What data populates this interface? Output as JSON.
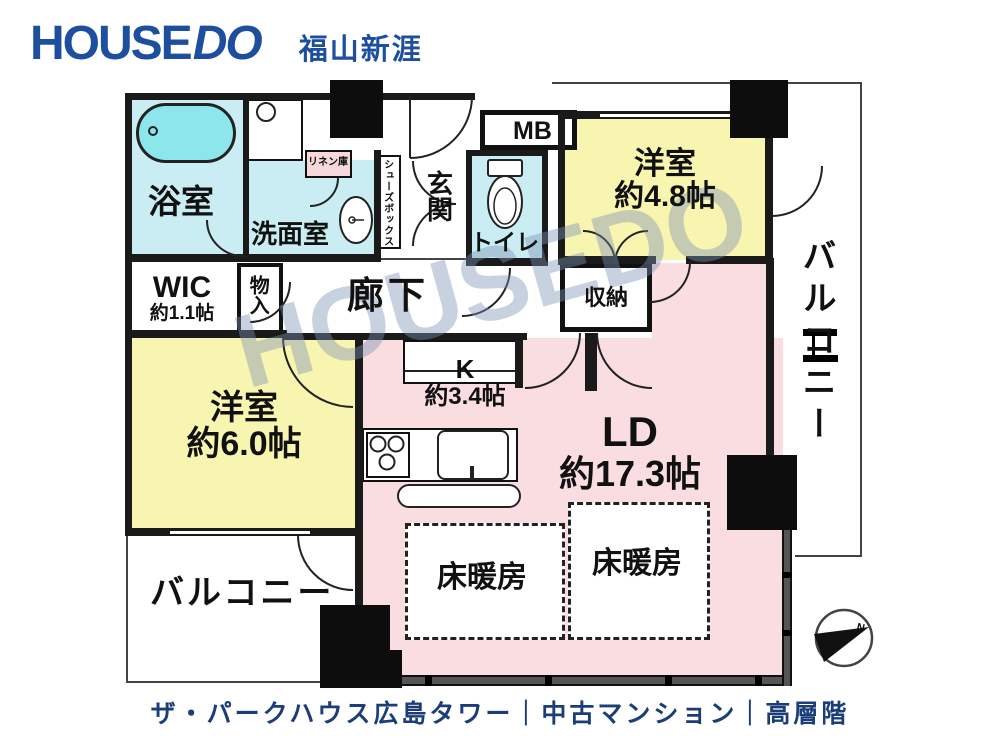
{
  "header": {
    "brand_house": "HOUSE",
    "brand_do": "DO",
    "branch": "福山新涯"
  },
  "watermark": "HOUSEDO",
  "caption": "ザ・パークハウス広島タワー｜中古マンション｜高層階",
  "rooms": {
    "bath": {
      "label": "浴室"
    },
    "powder": {
      "label": "洗面室"
    },
    "linen": {
      "label": "リネン庫"
    },
    "shoebox": {
      "label": "シューズボックス"
    },
    "entrance": {
      "label": "玄関"
    },
    "toilet": {
      "label": "トイレ"
    },
    "mb": {
      "label": "MB"
    },
    "bedroom1": {
      "label": "洋室",
      "size": "約4.8帖"
    },
    "closet": {
      "label": "収納"
    },
    "balcony_right": {
      "label": "バルコニー"
    },
    "wic": {
      "label": "WIC",
      "size": "約1.1帖"
    },
    "storage": {
      "label": "物入"
    },
    "hallway": {
      "label": "廊下"
    },
    "bedroom2": {
      "label": "洋室",
      "size": "約6.0帖"
    },
    "kitchen": {
      "label": "K",
      "size": "約3.4帖"
    },
    "ld": {
      "label": "LD",
      "size": "約17.3帖"
    },
    "floor_heating1": {
      "label": "床暖房"
    },
    "floor_heating2": {
      "label": "床暖房"
    },
    "balcony_bottom": {
      "label": "バルコニー"
    },
    "compass_north": "N"
  },
  "colors": {
    "brand_blue": "#1e4f9f",
    "caption_navy": "#1c3e78",
    "room_yellow": "#f8f5b0",
    "room_pink": "#fadde1",
    "room_cyan": "#c9edf2",
    "tub_cyan": "#8de6ec",
    "linen_pink": "#f6d8da",
    "wall_black": "#1a1a1a"
  }
}
